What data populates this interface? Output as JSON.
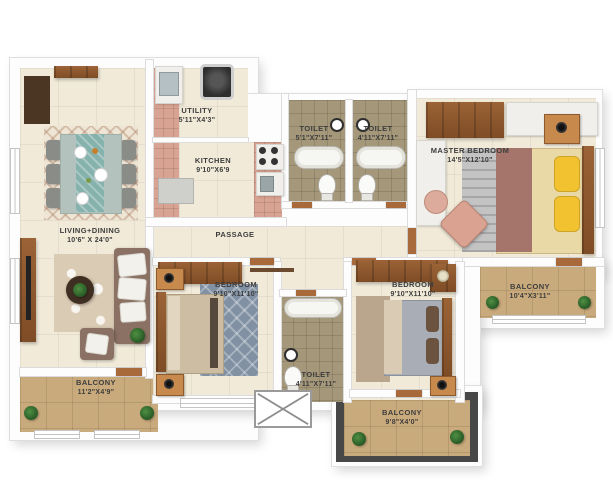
{
  "title": "3 BHK apartment floor plan",
  "rooms": {
    "living": {
      "name": "LIVING+DINING",
      "dims": "10'6\" X 24'0\""
    },
    "utility": {
      "name": "UTILITY",
      "dims": "5'11\"X4'3\""
    },
    "kitchen": {
      "name": "KITCHEN",
      "dims": "9'10\"X6'9"
    },
    "toilet1": {
      "name": "TOILET",
      "dims": "5'1\"X7'11\""
    },
    "toilet2": {
      "name": "TOILET",
      "dims": "4'11\"X7'11\""
    },
    "master": {
      "name": "MASTER BEDROOM",
      "dims": "14'5\"X12'10\""
    },
    "passage": {
      "name": "PASSAGE",
      "dims": ""
    },
    "bedroom1": {
      "name": "BEDROOM",
      "dims": "9'10\"X11'10\""
    },
    "bedroom2": {
      "name": "BEDROOM",
      "dims": "9'10\"X11'10\""
    },
    "toilet3": {
      "name": "TOILET",
      "dims": "4'11\"X7'11\""
    },
    "balcony1": {
      "name": "BALCONY",
      "dims": "11'2\"X4'9\""
    },
    "balcony2": {
      "name": "BALCONY",
      "dims": "10'4\"X3'11\""
    },
    "balcony3": {
      "name": "BALCONY",
      "dims": "9'8\"X4'0\""
    }
  },
  "colors": {
    "wall": "#ffffff",
    "floor": "#f1ead9",
    "kitchen_tile": "#d8a392",
    "toilet_tile": "#a59779",
    "balcony_tile": "#c9aa7c",
    "wood": "#8a5a33",
    "label_text": "#3d3d3d"
  }
}
